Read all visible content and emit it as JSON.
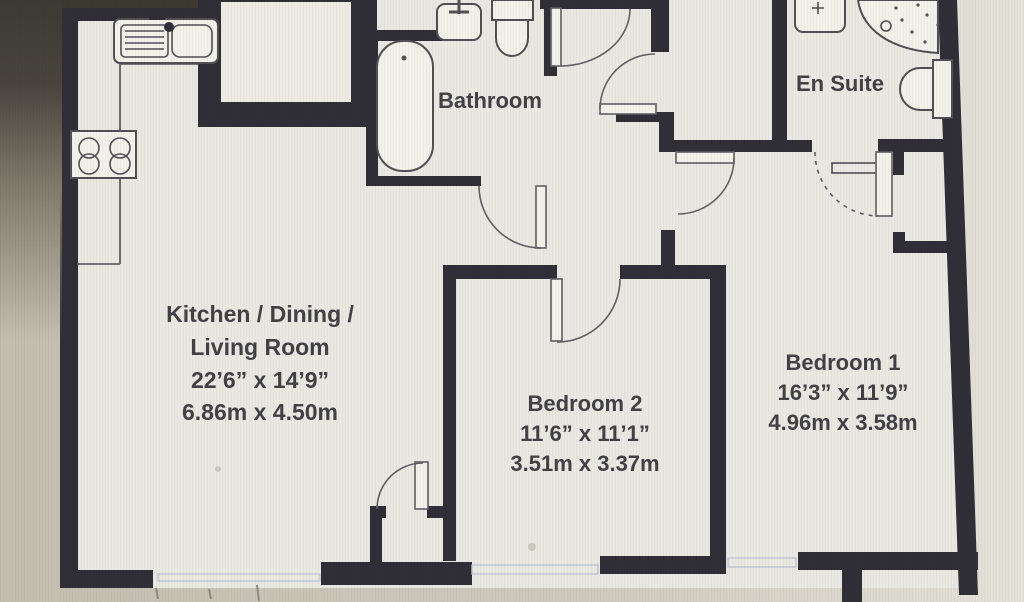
{
  "title": "Two bedroom apartment floor plan",
  "rooms": {
    "kitchen": {
      "line1": "Kitchen / Dining /",
      "line2": "Living Room",
      "imperial": "22’6” x 14’9”",
      "metric": "6.86m x 4.50m"
    },
    "bathroom": {
      "name": "Bathroom"
    },
    "ensuite": {
      "name": "En Suite"
    },
    "bedroom2": {
      "name": "Bedroom 2",
      "imperial": "11’6” x 11’1”",
      "metric": "3.51m x 3.37m"
    },
    "bedroom1": {
      "name": "Bedroom 1",
      "imperial": "16’3” x 11’9”",
      "metric": "4.96m x 3.58m"
    }
  },
  "fixtures": [
    "kitchen-sink",
    "hob",
    "bathtub",
    "bathroom-basin",
    "bathroom-toilet",
    "ensuite-basin",
    "shower",
    "ensuite-toilet",
    "towel-rail"
  ],
  "colors": {
    "wall": "#2c2b33",
    "floor": "#e9e8e1",
    "bg-dark": "#39362e",
    "bg-tan": "#c6c0b2",
    "line": "#4c4c52",
    "door-line": "#5d5d63",
    "window-tint": "#bcc5d6",
    "text": "#3d3d42",
    "fixture-fill": "#f2f1ea",
    "white-box": "#edebe4"
  }
}
